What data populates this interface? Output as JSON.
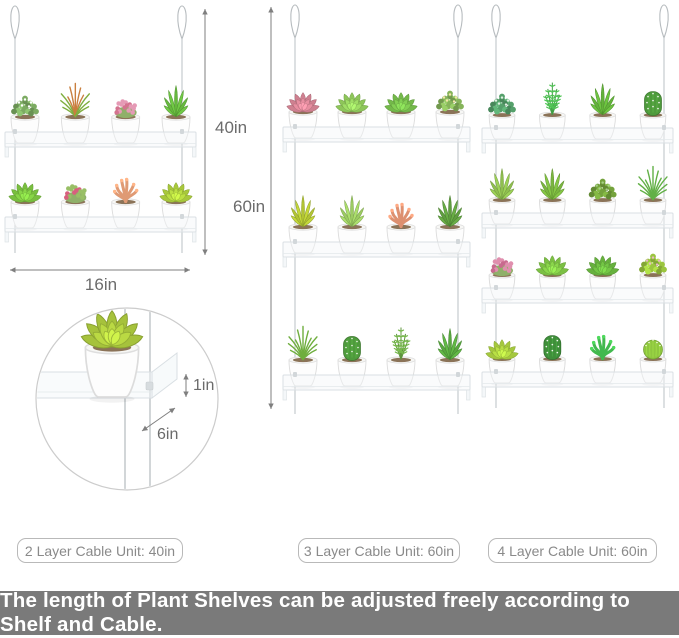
{
  "page": {
    "width": 679,
    "height": 638,
    "background": "#ffffff"
  },
  "dimension_labels": {
    "two_layer_height": "40in",
    "shelf_width": "16in",
    "tall_height": "60in",
    "lip_height": "1in",
    "shelf_depth": "6in"
  },
  "units": [
    {
      "layers": 2,
      "pots_per_shelf": 4,
      "shelves": [
        [
          "bush:#7cab62:#ffffff",
          "grass:#7fae3f:#c97f3f",
          "flowers:#e59ab5:#d4738f",
          "aloe:#66b83e"
        ],
        [
          "rosette:#79bf3f",
          "flowers:#99bf66:#d85f7e",
          "coral:#df9a74",
          "rosette:#a8c83c"
        ]
      ]
    },
    {
      "layers": 3,
      "pots_per_shelf": 4,
      "shelves": [
        [
          "rosette:#cf8090",
          "rosette:#8ec65a",
          "rosette:#74b94a",
          "bush:#86b45a:#f5e6a8"
        ],
        [
          "aloe:#b2c434",
          "aloe:#9ccb62",
          "coral:#dd9070",
          "aloe:#5f9e3f"
        ],
        [
          "grass:#6fae3e",
          "cactus:#4e9a3c",
          "fern:#77b94c",
          "aloe:#58a83f"
        ]
      ]
    },
    {
      "layers": 4,
      "pots_per_shelf": 4,
      "shelves": [
        [
          "bush:#55a06b:#dff0e2",
          "fern:#4fc554",
          "aloe:#63b33a",
          "cactus:#4e9a3c"
        ],
        [
          "aloe:#8fbf4f",
          "aloe:#7ab63f",
          "bush:#74a23c:#a8d08a",
          "grass:#62b046"
        ],
        [
          "flowers:#e08fae:#c86a8e",
          "rosette:#7cc044",
          "rosette:#67b13e",
          "bush:#9bc53f:#e8b7c8"
        ],
        [
          "rosette:#a5c83e",
          "cactus:#3f8f3a",
          "coral:#42b94e",
          "ball:#8fc63f"
        ]
      ]
    }
  ],
  "captions": [
    {
      "text": "2 Layer Cable Unit: 40in"
    },
    {
      "text": "3 Layer Cable Unit: 60in"
    },
    {
      "text": "4 Layer Cable Unit: 60in"
    }
  ],
  "detail": {
    "lip_label": "1in",
    "depth_label": "6in",
    "plant": "rosette:#a6c23c"
  },
  "banner": {
    "text": "The length of Plant Shelves can be adjusted freely according to Shelf and Cable.",
    "background": "#7a7a7a",
    "text_color": "#ffffff"
  },
  "style_colors": {
    "dimension_text": "#6b6b6b",
    "arrow": "#7f7f7f",
    "caption_text": "#8a8a8a",
    "caption_border": "#b9b9b9",
    "cable": "#c6cbce",
    "shelf_stroke": "#d9dfe3",
    "pot_fill": "#fdfdfd",
    "pot_stroke": "#dcdcdc"
  }
}
